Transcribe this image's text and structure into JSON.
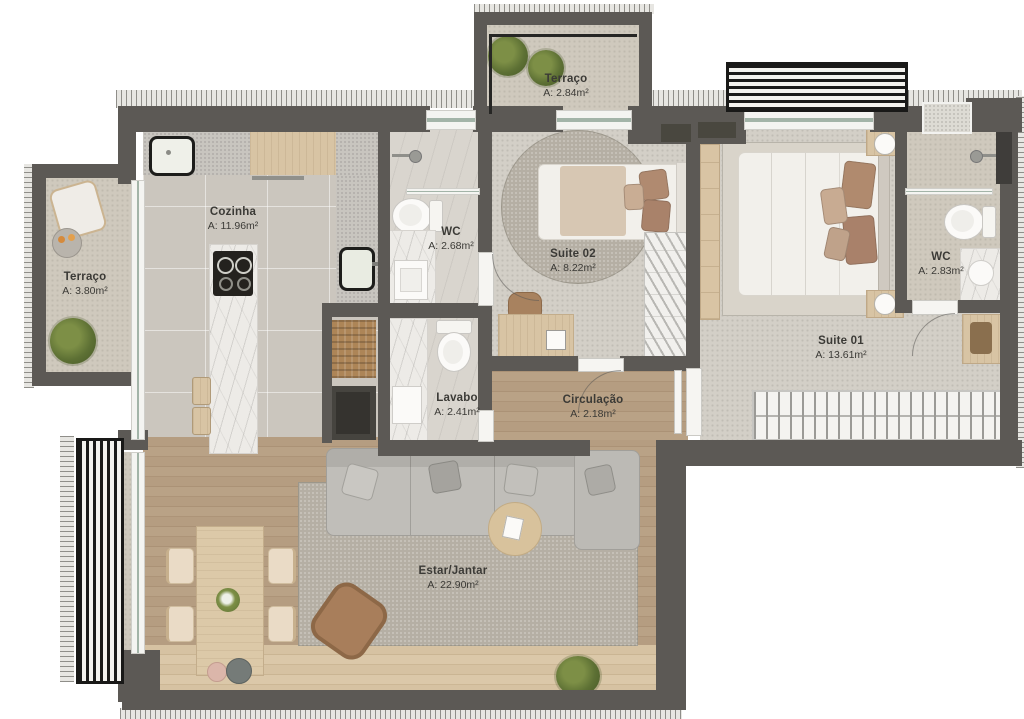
{
  "plan_title": "Apartment floor plan",
  "palette": {
    "wall": "#5c5955",
    "floor_tile": "#cbc6be",
    "floor_wood": "#b59d81",
    "floor_wood_light": "#d6c2a2",
    "floor_suite": "#d3cfc7",
    "marble": "#edebe7",
    "rug": "#b5afa4",
    "louver_black": "#191918",
    "plant_green": "#5d7034",
    "leather_brown": "#a87e5b",
    "label_text": "#3b3a36"
  },
  "rooms": {
    "terraco_top": {
      "name": "Terraço",
      "area": "A: 2.84m²"
    },
    "terraco_left": {
      "name": "Terraço",
      "area": "A: 3.80m²"
    },
    "cozinha": {
      "name": "Cozinha",
      "area": "A: 11.96m²"
    },
    "wc_suite02": {
      "name": "WC",
      "area": "A: 2.68m²"
    },
    "suite02": {
      "name": "Suite 02",
      "area": "A: 8.22m²"
    },
    "wc_suite01": {
      "name": "WC",
      "area": "A: 2.83m²"
    },
    "suite01": {
      "name": "Suite 01",
      "area": "A: 13.61m²"
    },
    "lavabo": {
      "name": "Lavabo",
      "area": "A: 2.41m²"
    },
    "circulacao": {
      "name": "Circulação",
      "area": "A: 2.18m²"
    },
    "estar_jantar": {
      "name": "Estar/Jantar",
      "area": "A: 22.90m²"
    }
  }
}
